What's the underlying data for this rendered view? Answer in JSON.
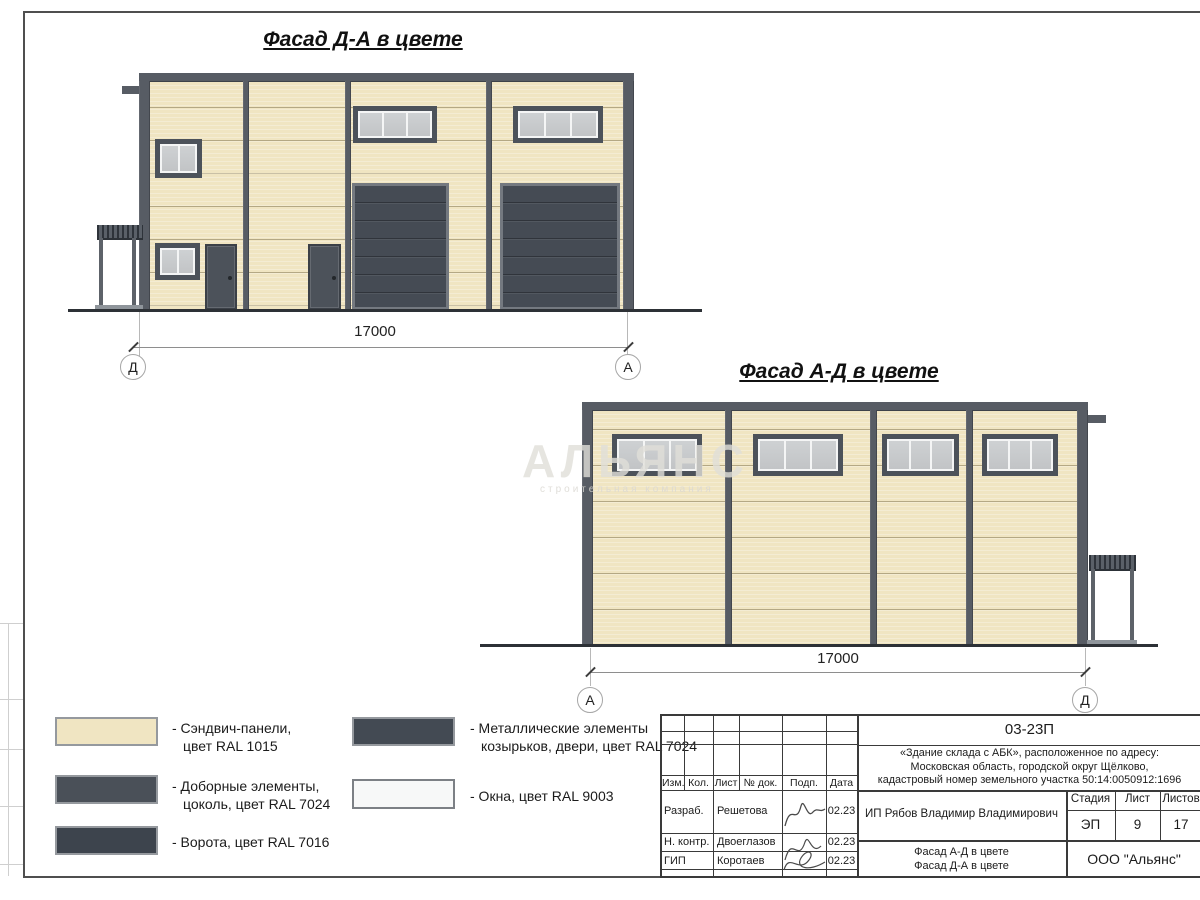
{
  "facade_da": {
    "title": "Фасад Д-А в цвете",
    "dimension": "17000",
    "axis_left": "Д",
    "axis_right": "А"
  },
  "facade_ad": {
    "title": "Фасад А-Д в цвете",
    "dimension": "17000",
    "axis_left": "А",
    "axis_right": "Д"
  },
  "watermark": {
    "line1": "АЛЬЯНС",
    "line2": "строительная компания"
  },
  "legend": {
    "items": [
      {
        "line1": "- Сэндвич-панели,",
        "line2": "цвет RAL 1015",
        "color": "#f0e5c2"
      },
      {
        "line1": "- Доборные элементы,",
        "line2": "цоколь, цвет RAL 7024",
        "color": "#4a5058"
      },
      {
        "line1": "- Ворота, цвет RAL 7016",
        "line2": "",
        "color": "#3d444d"
      },
      {
        "line1": "- Металлические элементы",
        "line2": "козырьков, двери, цвет RAL 7024",
        "color": "#434a53"
      },
      {
        "line1": "- Окна, цвет RAL 9003",
        "line2": "",
        "color": "#f7f8f8"
      }
    ]
  },
  "title_block": {
    "doc_number": "03-23П",
    "project": {
      "line1": "«Здание склада с АБК», расположенное по адресу:",
      "line2": "Московская область, городской округ Щёлково,",
      "line3": "кадастровый номер земельного участка 50:14:0050912:1696"
    },
    "client": "ИП Рябов Владимир Владимирович",
    "headers": {
      "izm": "Изм.",
      "kol": "Кол.",
      "list": "Лист",
      "ndok": "№ док.",
      "podp": "Подп.",
      "data": "Дата",
      "stadia": "Стадия",
      "list2": "Лист",
      "listov": "Листов"
    },
    "stadia": "ЭП",
    "sheet_no": "9",
    "sheets_total": "17",
    "rows": [
      {
        "role": "Разраб.",
        "name": "Решетова",
        "date": "02.23"
      },
      {
        "role": "Н. контр.",
        "name": "Двоеглазов",
        "date": "02.23"
      },
      {
        "role": "ГИП",
        "name": "Коротаев",
        "date": "02.23"
      }
    ],
    "sheet_title": {
      "line1": "Фасад А-Д в цвете",
      "line2": "Фасад Д-А в цвете"
    },
    "organization": "ООО \"Альянс\""
  },
  "colors": {
    "panel": "#f0e5c2",
    "metal_dark": "#575c64",
    "gate": "#454b54",
    "window_glass": "#c6c8ca",
    "window_frame": "#f4f5f5"
  }
}
